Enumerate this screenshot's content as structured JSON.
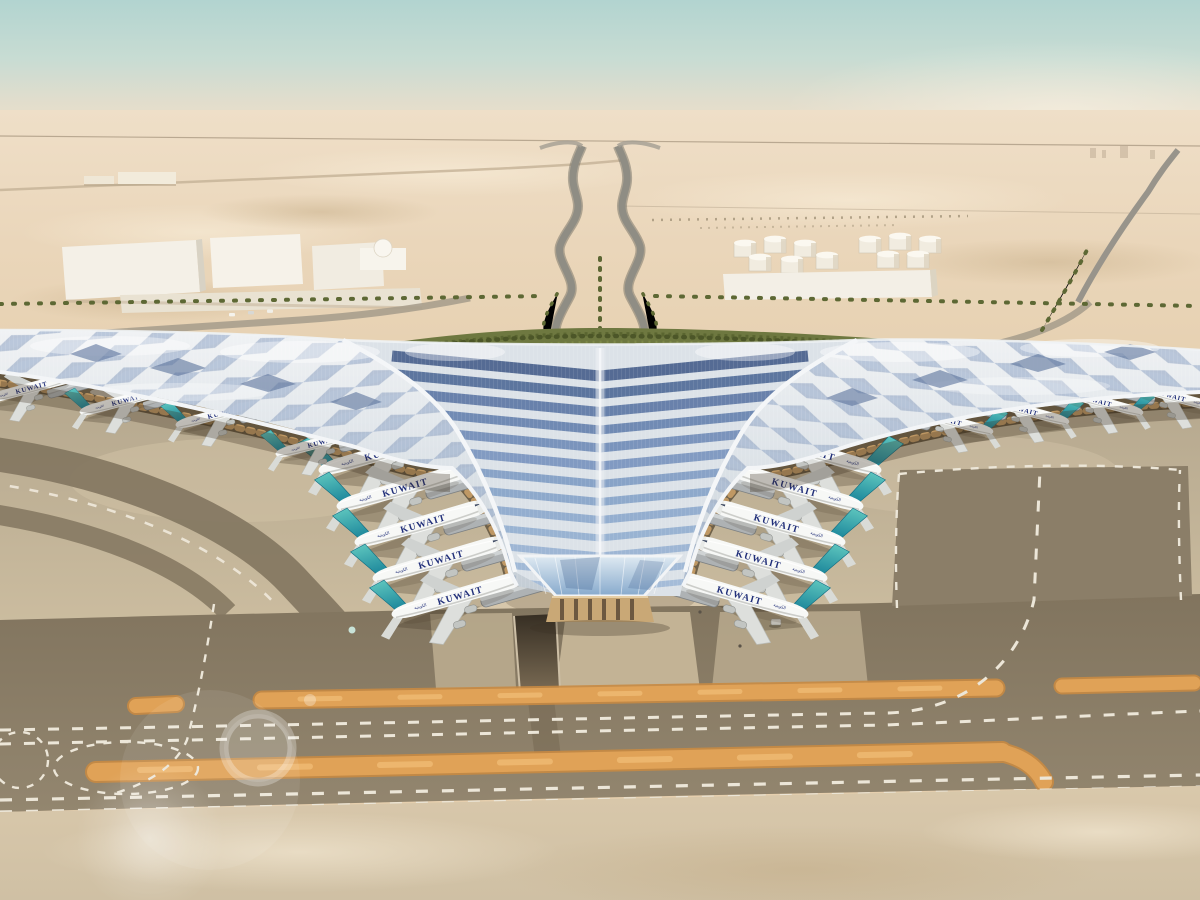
{
  "scene": {
    "description": "Aerial architectural rendering of Kuwait International Airport trefoil terminal in the desert",
    "airline_title": "KUWAIT",
    "airline_title_arabic": "الكويتية"
  },
  "aircraft": {
    "left_pier_count": 5,
    "right_pier_count": 5,
    "left_remote_count": 4,
    "right_remote_count": 4,
    "fuselage_color": "#f7f8f6",
    "tail_color": "#2ba2a6",
    "title_color": "#22307a"
  },
  "palette": {
    "sky_top": "#b2d4d0",
    "sky_horizon": "#eedfc8",
    "desert_sand": "#e6cfae",
    "apron_concrete": "#c8b99e",
    "taxiway_asphalt": "#8b7e68",
    "marking_white": "#ece6d8",
    "shoulder_orange": "#e0a257",
    "roof_silver": "#e9edf1",
    "solar_panel_blue": "#6e88b2",
    "greenery": "#6e7840",
    "facade_tan": "#c89f67"
  }
}
